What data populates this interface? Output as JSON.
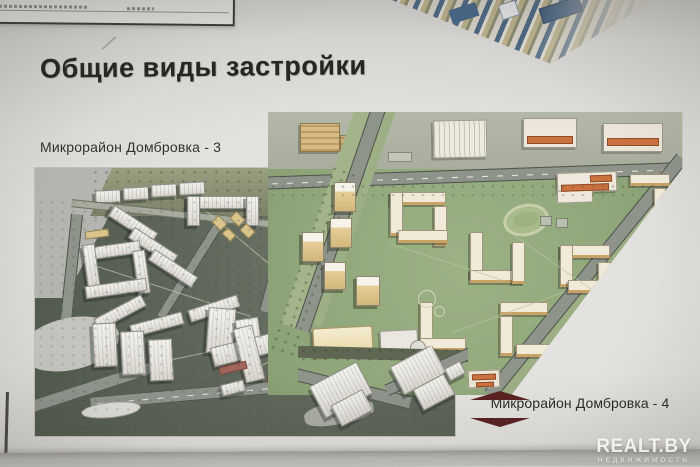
{
  "poster": {
    "title": "Общие виды застройки",
    "renderings": [
      {
        "id": "dombrovka-3",
        "label": "Микрорайон Домбровка - 3"
      },
      {
        "id": "dombrovka-4",
        "label": "Микрорайон Домбровка - 4"
      }
    ]
  },
  "watermark": {
    "brand": "REALT.BY",
    "tagline": "НЕДВИЖИМОСТЬ"
  },
  "colors": {
    "paper": "#e3e1de",
    "caption_accent_maroon": "#5a2020",
    "lawn_green": "#8fa77a",
    "terrain_gray_green": "#5d6658",
    "building_white": "#f2f1ed",
    "building_cream": "#f1ead9",
    "building_tan": "#d9c48c",
    "roof_orange": "#cb7340",
    "watermark_white": "rgba(255,255,255,0.85)"
  }
}
